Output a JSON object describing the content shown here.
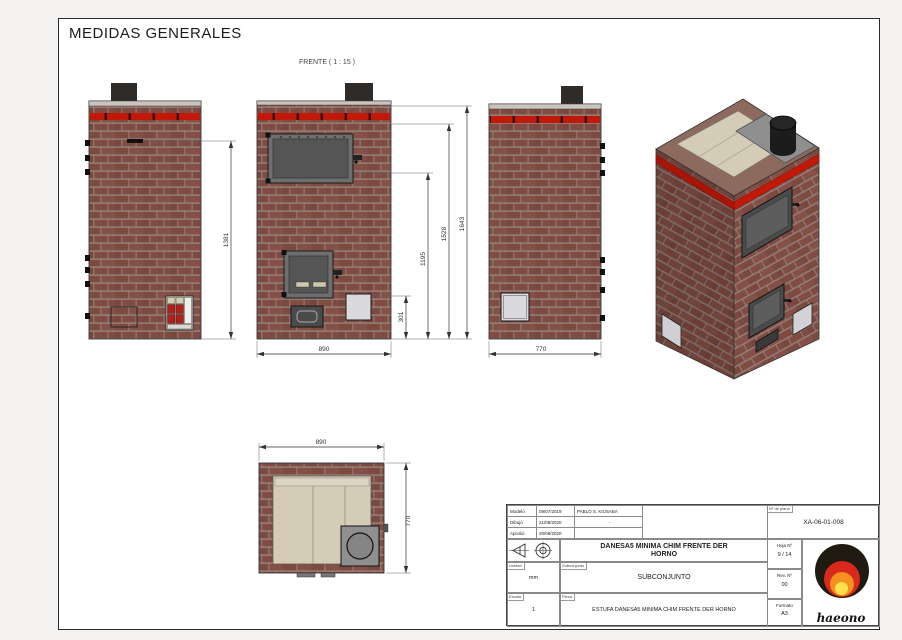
{
  "page": {
    "title": "MEDIDAS GENERALES"
  },
  "views": {
    "front_label": "FRENTE ( 1 : 15 )"
  },
  "dimensions": {
    "back_height": "1381",
    "front_h_1195": "1195",
    "front_h_1528": "1528",
    "front_h_1643": "1643",
    "front_h_301": "301",
    "front_width": "890",
    "side_width": "770",
    "top_width": "890",
    "top_depth": "770"
  },
  "title_block": {
    "approvals": [
      {
        "role": "Modeló",
        "date": "09/07/2019",
        "name": "PABLO S. KIUSABA"
      },
      {
        "role": "Dibujó",
        "date": "21/08/2020",
        "name": "-"
      },
      {
        "role": "Aprobó",
        "date": "20/08/2020",
        "name": ""
      }
    ],
    "drawing_no_label": "Nº de plano",
    "drawing_no": "XA-06-01-008",
    "title_line1": "DANESA5 MINIMA CHIM FRENTE DER",
    "title_line2": "HORNO",
    "subassembly_label": "Subconjunto",
    "subassembly": "SUBCONJUNTO",
    "part_label": "Pieza",
    "part": "ESTUFA DANESA5 MINIMA CHIM FRENTE DER HORNO",
    "unit_label": "Unidad",
    "unit": "mm",
    "scale_label": "Escala",
    "scale": "1",
    "sheet_label": "Hoja Nº",
    "sheet": "9 / 14",
    "rev_label": "Rev. Nº",
    "rev": "00",
    "format_label": "Formato",
    "format": "A3",
    "logo_text": "haeono"
  },
  "colors": {
    "brick": "#7d4a40",
    "mortar": "#96837c",
    "accent_red": "#c21807",
    "door_gray": "#4b4b4b",
    "plate_beige": "#d5ccb8"
  }
}
